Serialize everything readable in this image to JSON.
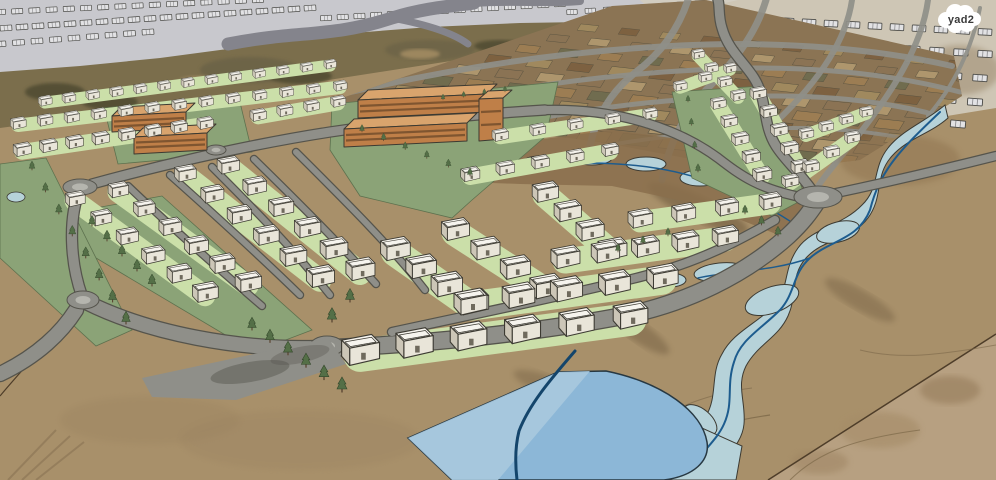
{
  "title": "3D masterplan rendering of a planned residential neighborhood",
  "watermark": {
    "label": "yad2"
  },
  "colors": {
    "plane": "#c8c8cd",
    "sketch_fill": "#e2e2e4",
    "sketch_fill2": "#c9c9cc",
    "outline": "#3c3a32",
    "road": "#8f8f89",
    "road_edge": "#55544c",
    "road_light": "#b5b5ae",
    "road_top": "#84848c",
    "terrain": "#a8906a",
    "terrain_right": "#b7a081",
    "hill_base": "#7b6e4c",
    "hill_dark": "#554f36",
    "hill_mid": "#6b6246",
    "hill_light": "#9d875f",
    "grid_base": "#8b7454",
    "parcel_palette": [
      "#9d7e53",
      "#7d6040",
      "#b0986f",
      "#6f6c4f",
      "#a28b5f",
      "#8b7355"
    ],
    "park": "#8ba377",
    "lawn": "#cbdfa9",
    "tree": "#546f47",
    "tree_dark": "#33472a",
    "trunk": "#5b4733",
    "house_top": "#f6f4ee",
    "house_front": "#e9e5d9",
    "house_side": "#ccc6b7",
    "orange_top": "#d9a46d",
    "orange_face": "#bf7f48",
    "orange_band": "#7f5530",
    "wadi": "#b6d2d9",
    "wadi_strip": "#8a6f4c",
    "stream": "#1d5c8e",
    "stream_dark": "#14456b",
    "pond": "#8cb7d7",
    "pond_light": "#a9c9de",
    "shadow": "#5f4c33",
    "boundary": "#4e3d29",
    "badge_text": "#3a3a3a",
    "white": "#ffffff"
  },
  "scene": {
    "house_rows": [
      [
        45,
        105,
        330,
        68,
        13,
        0.42,
        0.38
      ],
      [
        18,
        128,
        340,
        90,
        13,
        0.48,
        0.42
      ],
      [
        22,
        155,
        205,
        128,
        8,
        0.55,
        0.5
      ],
      [
        258,
        120,
        338,
        106,
        4,
        0.5,
        0.46
      ],
      [
        75,
        205,
        205,
        300,
        6,
        0.6,
        0.78
      ],
      [
        118,
        196,
        248,
        290,
        6,
        0.62,
        0.8
      ],
      [
        185,
        180,
        320,
        285,
        6,
        0.66,
        0.85
      ],
      [
        228,
        172,
        360,
        278,
        6,
        0.68,
        0.88
      ],
      [
        395,
        258,
        472,
        312,
        4,
        0.9,
        0.98
      ],
      [
        455,
        238,
        545,
        296,
        4,
        0.85,
        0.95
      ],
      [
        545,
        200,
        612,
        258,
        4,
        0.8,
        0.88
      ],
      [
        360,
        362,
        630,
        326,
        6,
        1.15,
        1.05
      ],
      [
        470,
        312,
        662,
        286,
        5,
        1.0,
        0.95
      ],
      [
        565,
        266,
        725,
        244,
        5,
        0.88,
        0.8
      ],
      [
        640,
        226,
        770,
        208,
        4,
        0.75,
        0.68
      ],
      [
        470,
        180,
        610,
        155,
        5,
        0.58,
        0.52
      ],
      [
        500,
        140,
        650,
        118,
        5,
        0.5,
        0.45
      ],
      [
        718,
        108,
        762,
        180,
        5,
        0.48,
        0.58
      ],
      [
        758,
        98,
        800,
        172,
        5,
        0.5,
        0.56
      ],
      [
        790,
        186,
        852,
        142,
        4,
        0.52,
        0.48
      ],
      [
        806,
        138,
        866,
        116,
        4,
        0.46,
        0.42
      ],
      [
        698,
        58,
        738,
        100,
        4,
        0.4,
        0.46
      ],
      [
        680,
        90,
        730,
        72,
        3,
        0.42,
        0.4
      ]
    ],
    "tree_rows": [
      [
        32,
        170,
        126,
        324,
        8,
        0.6,
        0.85
      ],
      [
        252,
        330,
        342,
        392,
        6,
        0.85,
        1.0
      ],
      [
        92,
        226,
        152,
        286,
        5,
        0.7,
        0.8
      ],
      [
        362,
        132,
        470,
        176,
        6,
        0.5,
        0.55
      ],
      [
        443,
        100,
        505,
        92,
        4,
        0.4,
        0.4
      ],
      [
        688,
        102,
        698,
        172,
        4,
        0.45,
        0.55
      ],
      [
        745,
        214,
        778,
        236,
        3,
        0.6,
        0.65
      ],
      [
        618,
        252,
        668,
        236,
        3,
        0.55,
        0.55
      ],
      [
        350,
        302,
        332,
        322,
        2,
        0.9,
        0.95
      ]
    ],
    "sketch_rows": [
      [
        6,
        28,
        310,
        8,
        20,
        -4,
        0.9
      ],
      [
        0,
        12,
        258,
        0,
        16,
        -3,
        0.85
      ],
      [
        326,
        18,
        560,
        4,
        15,
        -3,
        0.85
      ],
      [
        572,
        12,
        700,
        3,
        8,
        -3,
        0.8
      ],
      [
        0,
        44,
        148,
        32,
        9,
        -4,
        0.9
      ],
      [
        655,
        14,
        985,
        32,
        16,
        3,
        1.05
      ],
      [
        648,
        32,
        985,
        54,
        15,
        3,
        1.1
      ],
      [
        650,
        52,
        980,
        78,
        14,
        4,
        1.1
      ],
      [
        658,
        72,
        975,
        102,
        13,
        4,
        1.15
      ],
      [
        700,
        94,
        958,
        124,
        11,
        5,
        1.15
      ]
    ],
    "grid": {
      "origin": [
        348,
        112
      ],
      "u": [
        41,
        4
      ],
      "v": [
        30,
        -10.5
      ],
      "cols": 13,
      "rows": 9,
      "pw": 30,
      "ph": 11,
      "rot": 6,
      "skew": -25,
      "shrink": 0.05
    }
  }
}
